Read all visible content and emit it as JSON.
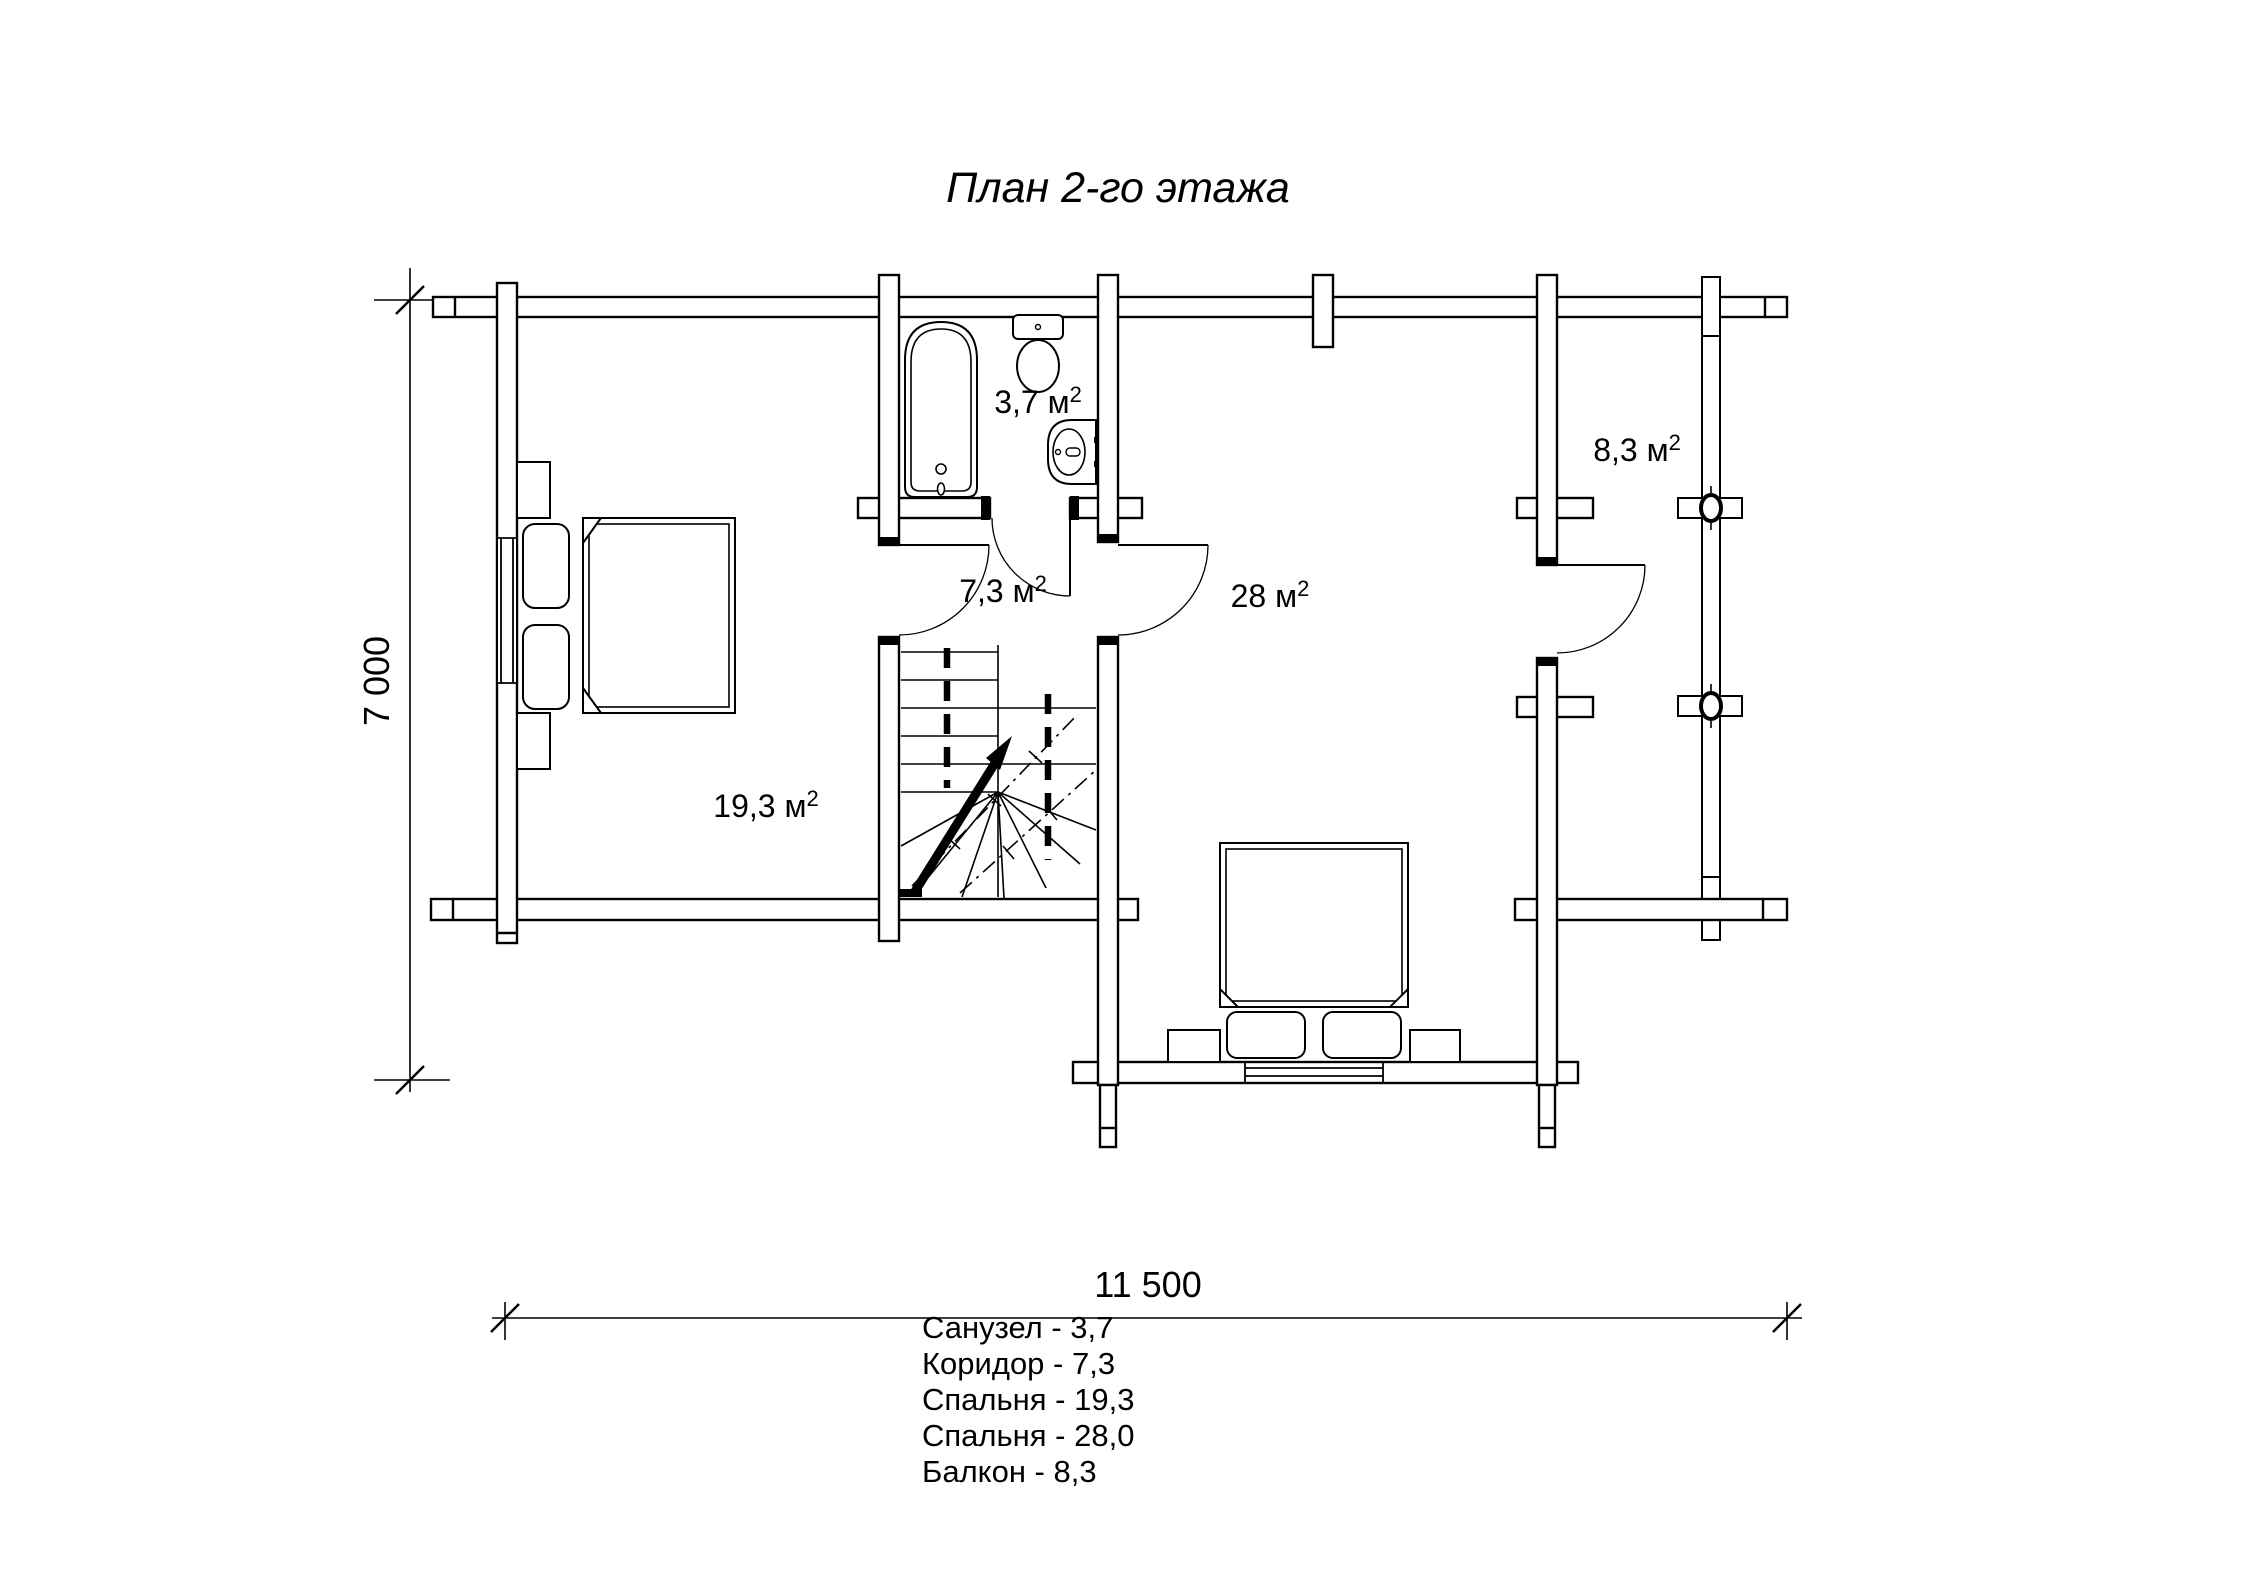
{
  "title": "План 2-го этажа",
  "areas": {
    "bathroom": {
      "value": "3,7",
      "unit": " м",
      "exp": "2"
    },
    "corridor": {
      "value": "7,3",
      "unit": " м",
      "exp": "2"
    },
    "bedroom_small": {
      "value": "19,3",
      "unit": " м",
      "exp": "2"
    },
    "bedroom_large": {
      "value": "28",
      "unit": " м",
      "exp": "2"
    },
    "balcony": {
      "value": "8,3",
      "unit": " м",
      "exp": "2"
    }
  },
  "dimensions": {
    "width": "11 500",
    "height": "7 000"
  },
  "legend": {
    "items": [
      "Санузел - 3,7",
      "Коридор - 7,3",
      "Спальня - 19,3",
      "Спальня - 28,0",
      "Балкон - 8,3"
    ]
  }
}
